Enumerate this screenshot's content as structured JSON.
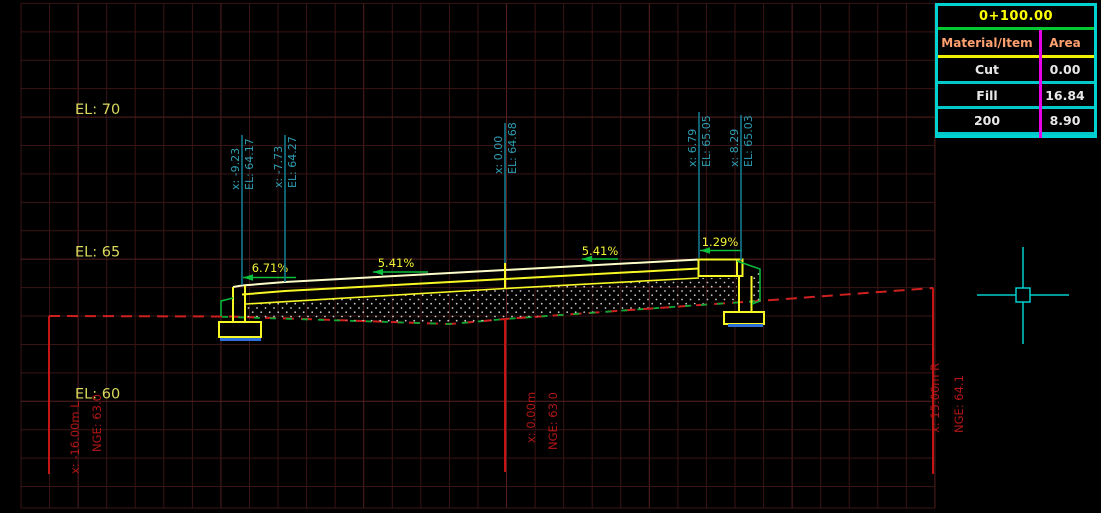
{
  "drawing": {
    "elevation_labels": [
      "EL: 70",
      "EL: 65",
      "EL: 60"
    ],
    "slope_labels": [
      "6.71%",
      "5.41%",
      "5.41%",
      "1.29%"
    ],
    "offset_markers": [
      {
        "offset": "x: -9.23",
        "elevation": "EL: 64.17"
      },
      {
        "offset": "x: -7.73",
        "elevation": "EL: 64.27"
      },
      {
        "offset": "x: 0.00",
        "elevation": "EL: 64.68"
      },
      {
        "offset": "x: 6.79",
        "elevation": "EL: 65.05"
      },
      {
        "offset": "x: 8.29",
        "elevation": "EL: 65.03"
      }
    ],
    "station_markers": [
      {
        "offset": "x: -16.00m L",
        "ground": "NGE: 63.0"
      },
      {
        "offset": "x: 0.00m",
        "ground": "NGE: 63.0"
      },
      {
        "offset": "x: 15.00m R",
        "ground": "NGE: 64.1"
      }
    ]
  },
  "quantity_table": {
    "station": "0+100.00",
    "headers": {
      "material": "Material/Item",
      "area": "Area"
    },
    "rows": [
      {
        "material": "Cut",
        "area": "0.00"
      },
      {
        "material": "Fill",
        "area": "16.84"
      },
      {
        "material": "200",
        "area": "8.90"
      }
    ]
  },
  "colors": {
    "grid_minor": "#3a1414",
    "grid_major": "#552020",
    "structure_yellow": "#f7f725",
    "surface_pale": "#fdfdc9",
    "existing_ground_red": "#cf2020",
    "design_green": "#0abf3c",
    "marker_cyan": "#2f9fb4",
    "leader_cyan": "#11798e",
    "station_red": "#c41414",
    "footing_base_blue": "#2e6fd9",
    "table_border": "#00d2d2",
    "crosshair": "#00cdcd",
    "elevation_text": "#d9d95d",
    "slope_text": "#f4f437"
  }
}
